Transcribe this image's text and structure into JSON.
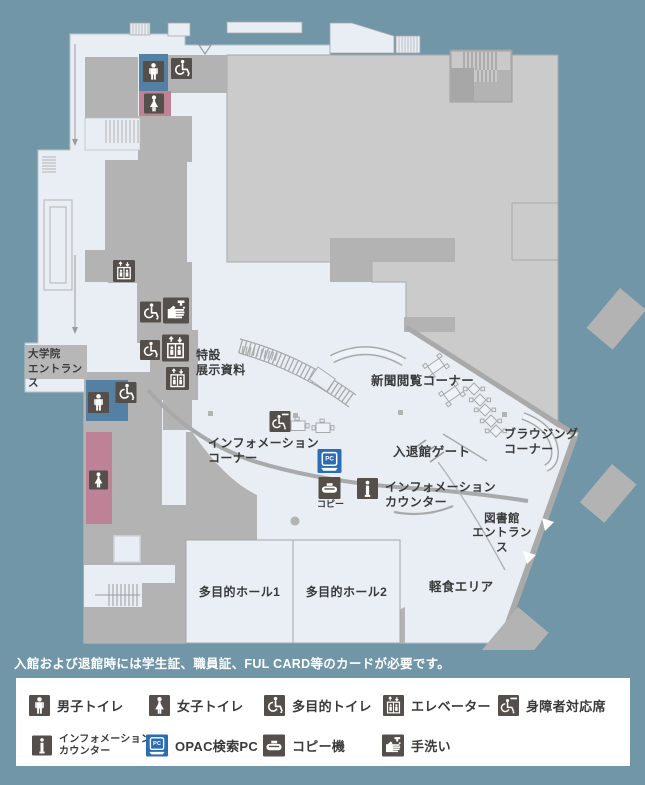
{
  "colors": {
    "background": "#7196a8",
    "floor_light": "#e8eef3",
    "block_gray": "#cbcbcb",
    "room_gray": "#b3b3b3",
    "wall_gray": "#a9a9a9",
    "icon_dark": "#544f4b",
    "opac_blue": "#2c6cb5",
    "toilet_blue": "#5480a4",
    "toilet_pink": "#bd8296"
  },
  "map": {
    "labels": {
      "grad_entrance": "大学院\nエントランス",
      "special_exhibit": "特設\n展示資料",
      "newspaper_corner": "新聞閲覧コーナー",
      "browsing_corner": "ブラウジング\nコーナー",
      "info_corner": "インフォメーション\nコーナー",
      "entrance_gate": "入退館ゲート",
      "info_counter": "インフォメーション\nカウンター",
      "library_entrance": "図書館\nエントランス",
      "snack_area": "軽食エリア",
      "hall1": "多目的ホール1",
      "hall2": "多目的ホール2",
      "copy": "コピー"
    }
  },
  "note": "入館および退館時には学生証、職員証、FUL CARD等のカードが必要です。",
  "legend": {
    "items": [
      {
        "id": "male-toilet",
        "label": "男子トイレ"
      },
      {
        "id": "female-toilet",
        "label": "女子トイレ"
      },
      {
        "id": "multipurpose-toilet",
        "label": "多目的トイレ"
      },
      {
        "id": "elevator",
        "label": "エレベーター"
      },
      {
        "id": "accessible-seat",
        "label": "身障者対応席"
      },
      {
        "id": "info-counter",
        "label": "インフォメーション\nカウンター"
      },
      {
        "id": "opac-pc",
        "label": "OPAC検索PC"
      },
      {
        "id": "copier",
        "label": "コピー機"
      },
      {
        "id": "hand-wash",
        "label": "手洗い"
      }
    ]
  }
}
